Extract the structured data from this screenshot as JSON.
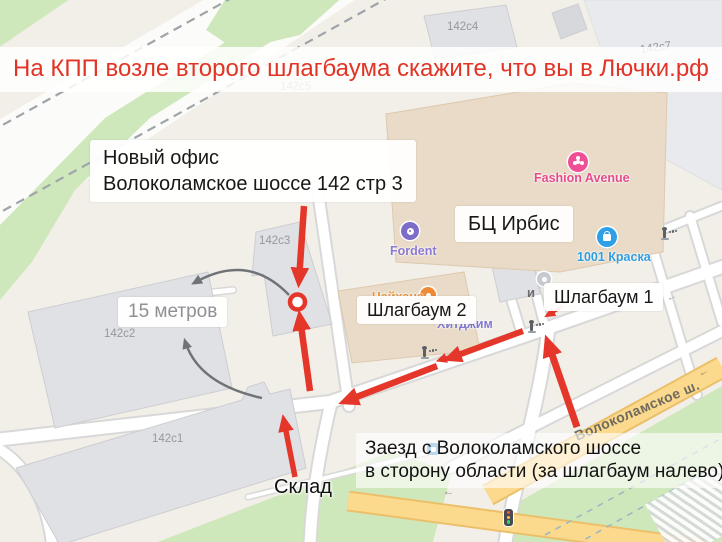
{
  "banner": {
    "text": "На КПП возле второго шлагбаума скажите, что вы в Лючки.рф"
  },
  "callouts": {
    "office": {
      "line1": "Новый офис",
      "line2": "Волоколамское шоссе 142 стр 3"
    },
    "business_center": "БЦ Ирбис",
    "barrier2": "Шлагбаум 2",
    "barrier1": "Шлагбаум 1",
    "distance": "15 метров",
    "warehouse": "Склад",
    "entry": {
      "line1": "Заезд с Волоколамского шоссе",
      "line2": "в сторону области (за шлагбаум налево)"
    }
  },
  "map": {
    "street_label": "Волоколамское ш.",
    "buildings": [
      {
        "id": "142c4",
        "label": "142с4"
      },
      {
        "id": "142c7",
        "label": "142с7"
      },
      {
        "id": "142c5",
        "label": "142с5"
      },
      {
        "id": "142c3",
        "label": "142с3"
      },
      {
        "id": "142c2",
        "label": "142с2"
      },
      {
        "id": "142c1",
        "label": "142с1"
      }
    ],
    "pois": [
      {
        "name": "Fashion Avenue",
        "color": "#e8478f"
      },
      {
        "name": "Fordent",
        "color": "#7d6bc7"
      },
      {
        "name": "1001 Краска",
        "color": "#2f9fe0"
      },
      {
        "name": "Чайхана",
        "color": "#ee8d3e"
      },
      {
        "name": "Хитджим",
        "color": "#8079cc"
      }
    ],
    "label_fragment": "и",
    "road_arrow": "←"
  },
  "colors": {
    "accent": "#e5362a",
    "arc_gray": "#6f7276",
    "road_yellow": "#fbd98d",
    "green": "#cfe8bb"
  }
}
